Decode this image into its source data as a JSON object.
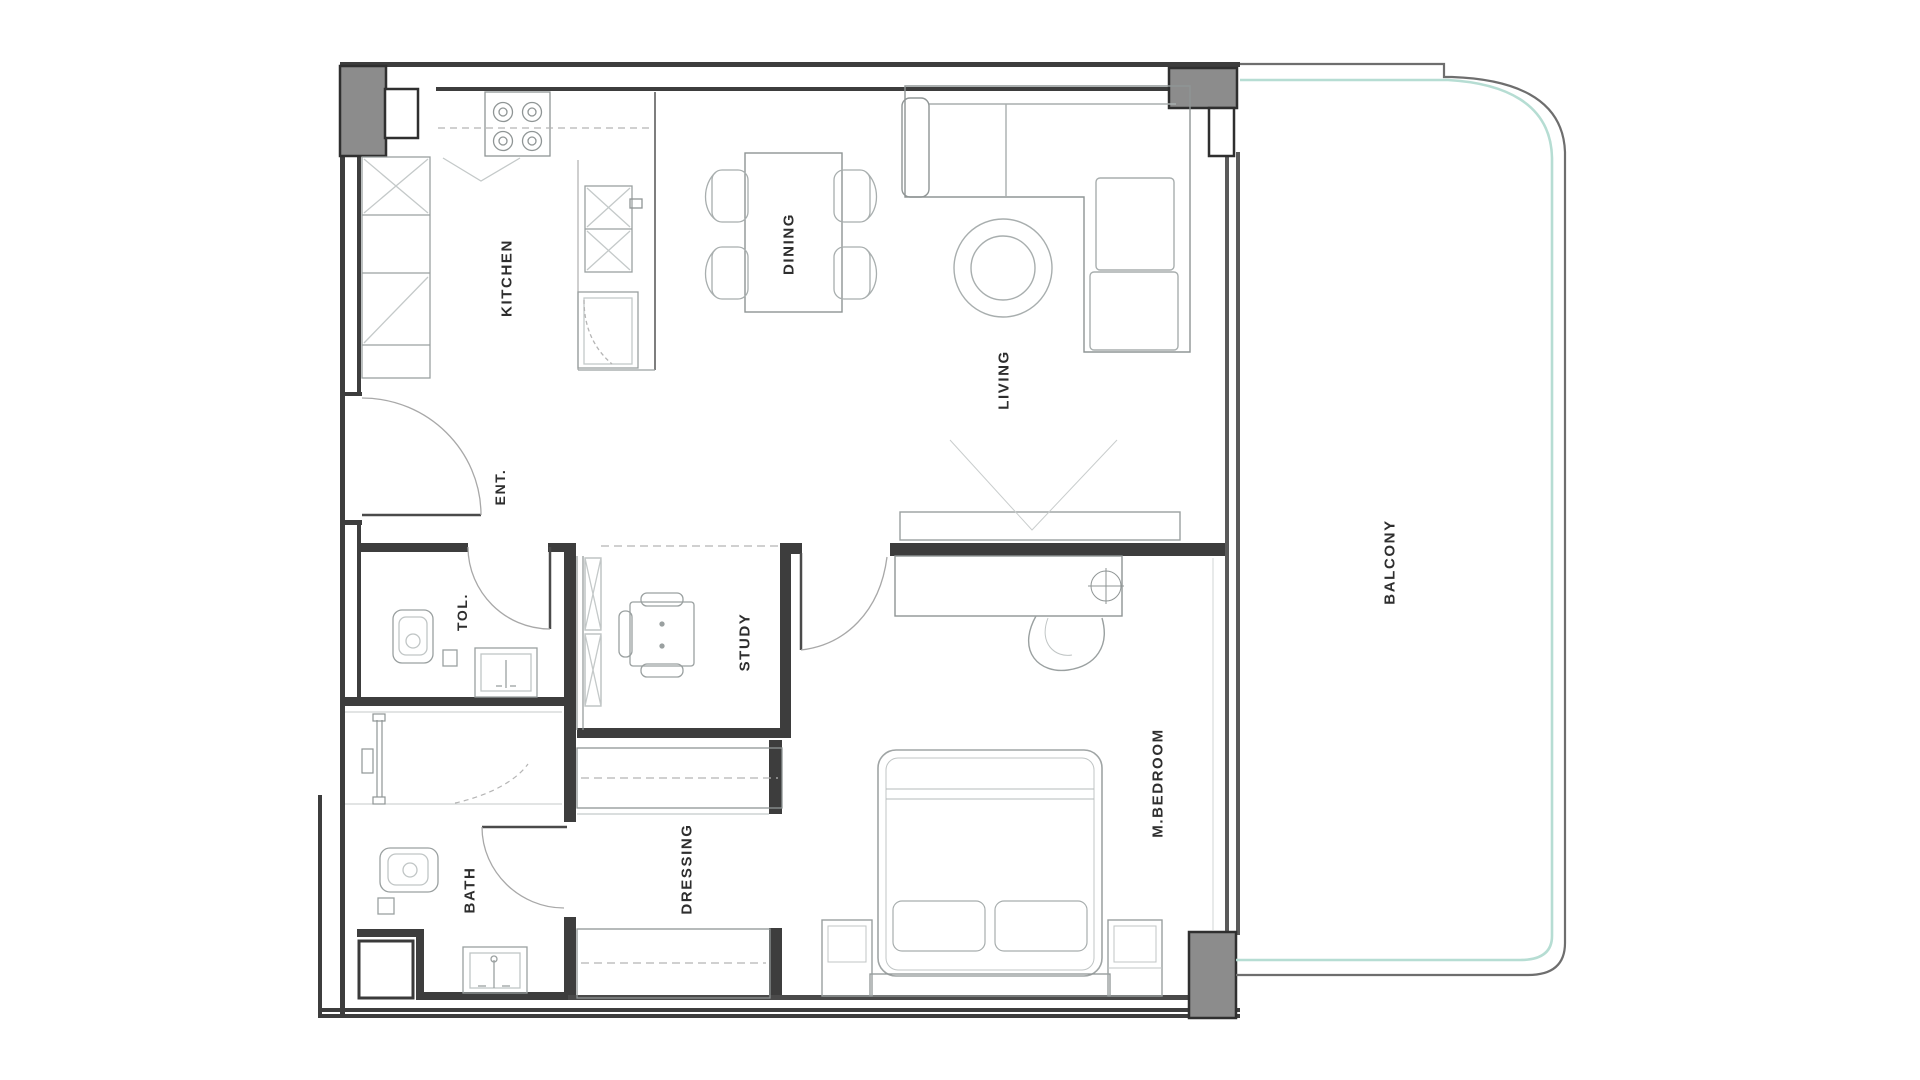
{
  "floor_plan": {
    "rooms": [
      {
        "id": "kitchen",
        "label": "KITCHEN"
      },
      {
        "id": "dining",
        "label": "DINING"
      },
      {
        "id": "living",
        "label": "LIVING"
      },
      {
        "id": "ent",
        "label": "ENT."
      },
      {
        "id": "tol",
        "label": "TOL."
      },
      {
        "id": "study",
        "label": "STUDY"
      },
      {
        "id": "bath",
        "label": "BATH"
      },
      {
        "id": "dressing",
        "label": "DRESSING"
      },
      {
        "id": "m_bedroom",
        "label": "M.BEDROOM"
      },
      {
        "id": "balcony",
        "label": "BALCONY"
      }
    ],
    "colors": {
      "background": "#ffffff",
      "wall": "#3d3d3d",
      "wall_medium": "#5a5a5a",
      "column_fill": "#8c8c8c",
      "furniture_line": "#9aa0a0",
      "furniture_light": "#c4c9c9",
      "door_arc": "#a8a8a8",
      "balcony_glass_teal": "#b6ddd3",
      "label_text": "#2e2e2e"
    },
    "symbols": [
      "column-icon",
      "stove-icon",
      "kitchen-sink-icon",
      "refrigerator-icon",
      "dishwasher-icon",
      "dining-table-icon",
      "chair-icon",
      "sofa-icon",
      "coffee-table-icon",
      "tv-console-icon",
      "door-swing-icon",
      "toilet-icon",
      "washbasin-icon",
      "shower-screen-icon",
      "shaft-icon",
      "wardrobe-icon",
      "desk-chair-icon",
      "dressing-cabinet-icon",
      "vanity-mirror-icon",
      "bed-icon",
      "pillow-icon",
      "nightstand-icon",
      "balcony-rail-icon"
    ]
  }
}
